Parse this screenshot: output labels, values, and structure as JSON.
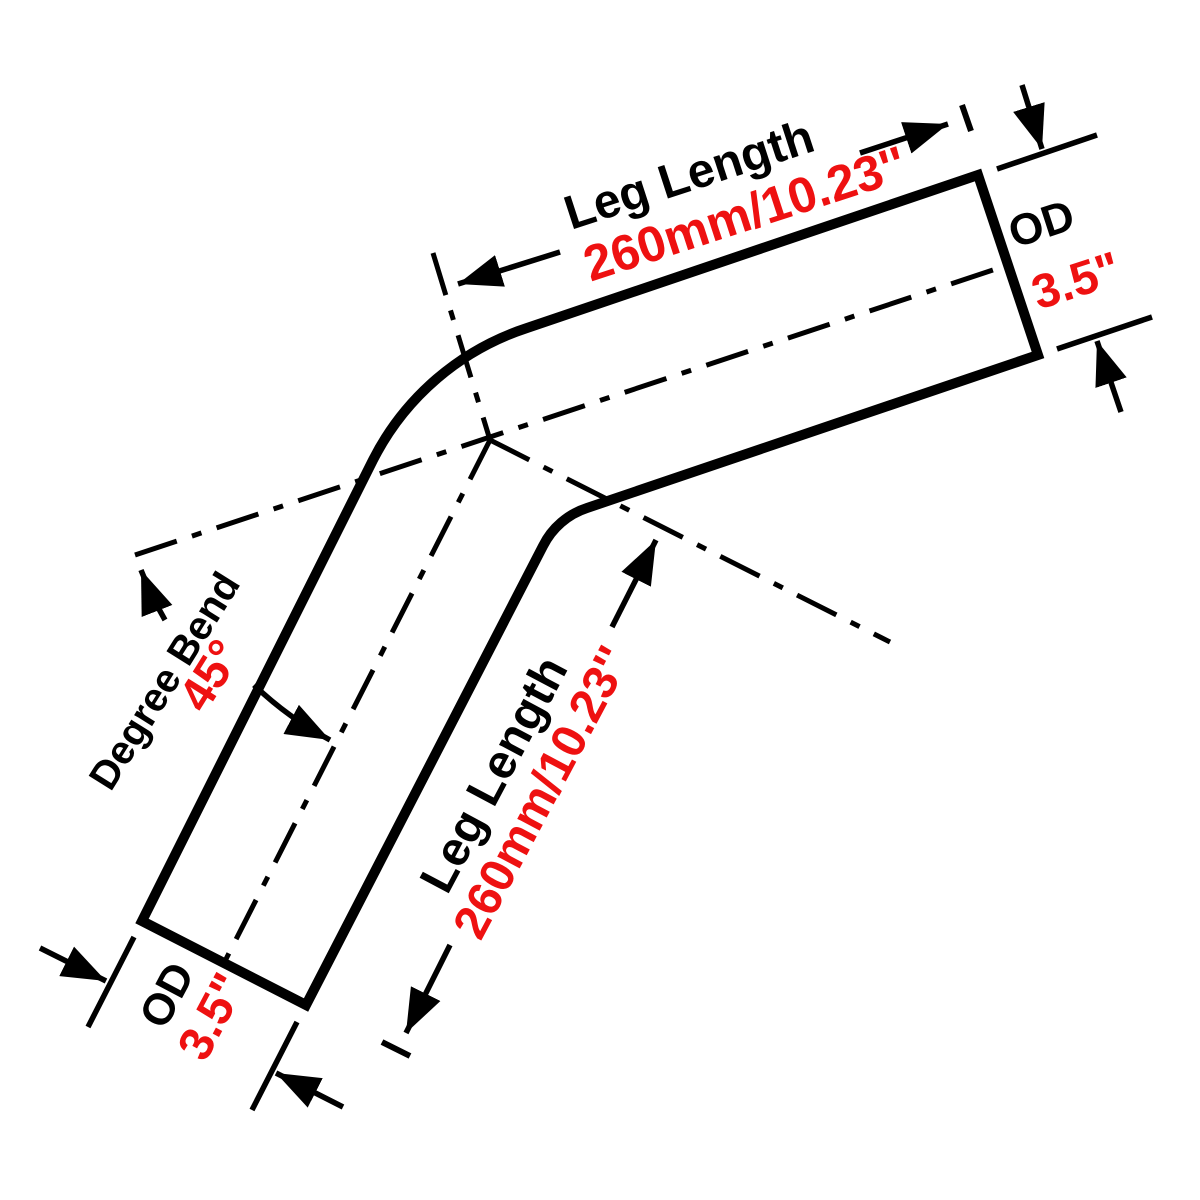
{
  "page": {
    "background": "#ffffff"
  },
  "colors": {
    "line": "#000000",
    "accent_red": "#ee1111",
    "pipe_fill": "#ffffff"
  },
  "annotations": {
    "upper_leg": {
      "label": "Leg Length",
      "value": "260mm/10.23''"
    },
    "od_right": {
      "label": "OD",
      "value": "3.5\""
    },
    "bend": {
      "label": "Degree Bend",
      "value": "45°"
    },
    "lower_leg": {
      "label": "Leg Length",
      "value": "260mm/10.23''"
    },
    "od_left": {
      "label": "OD",
      "value": "3.5\""
    }
  }
}
